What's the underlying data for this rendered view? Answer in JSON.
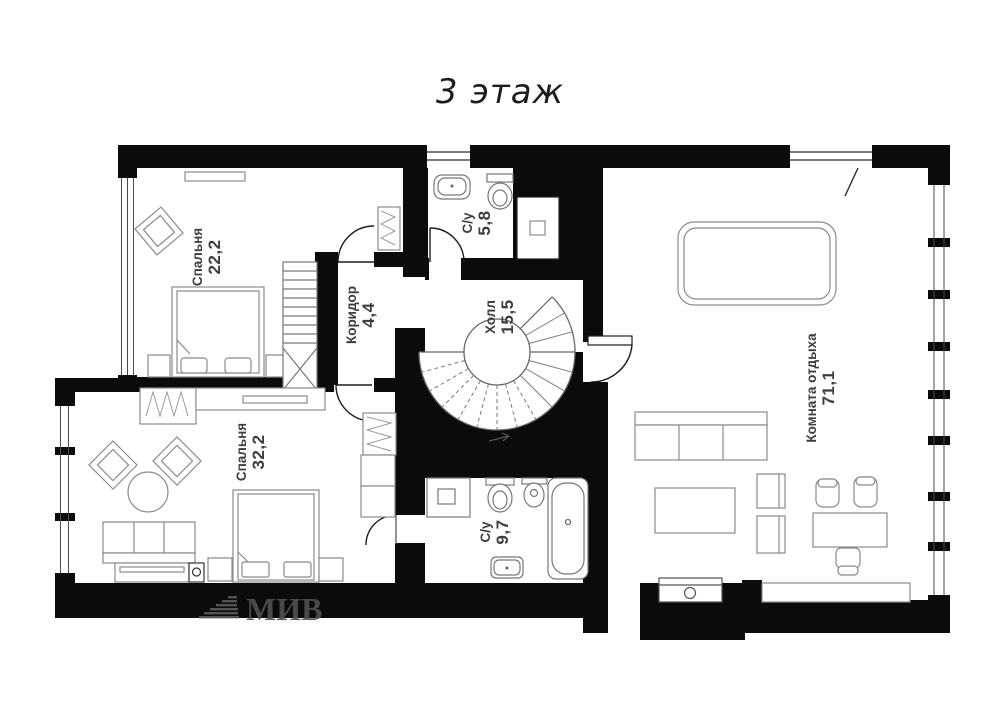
{
  "title": "3 этаж",
  "watermark": "МИВ",
  "rooms": {
    "bedroom_top": {
      "name": "Спальня",
      "area": "22,2"
    },
    "corridor": {
      "name": "Коридор",
      "area": "4,4"
    },
    "bathroom_top": {
      "name": "С/у",
      "area": "5,8"
    },
    "hall": {
      "name": "Холл",
      "area": "15,5"
    },
    "lounge": {
      "name": "Комната отдыха",
      "area": "71,1"
    },
    "bedroom_bottom": {
      "name": "Спальня",
      "area": "32,2"
    },
    "bathroom_bottom": {
      "name": "С/у",
      "area": "9,7"
    }
  },
  "colors": {
    "wall": "#0b0b0b",
    "furniture_stroke": "#8a8a8a",
    "label_text": "#3d3d3d",
    "watermark": "#535353",
    "background": "#ffffff"
  }
}
